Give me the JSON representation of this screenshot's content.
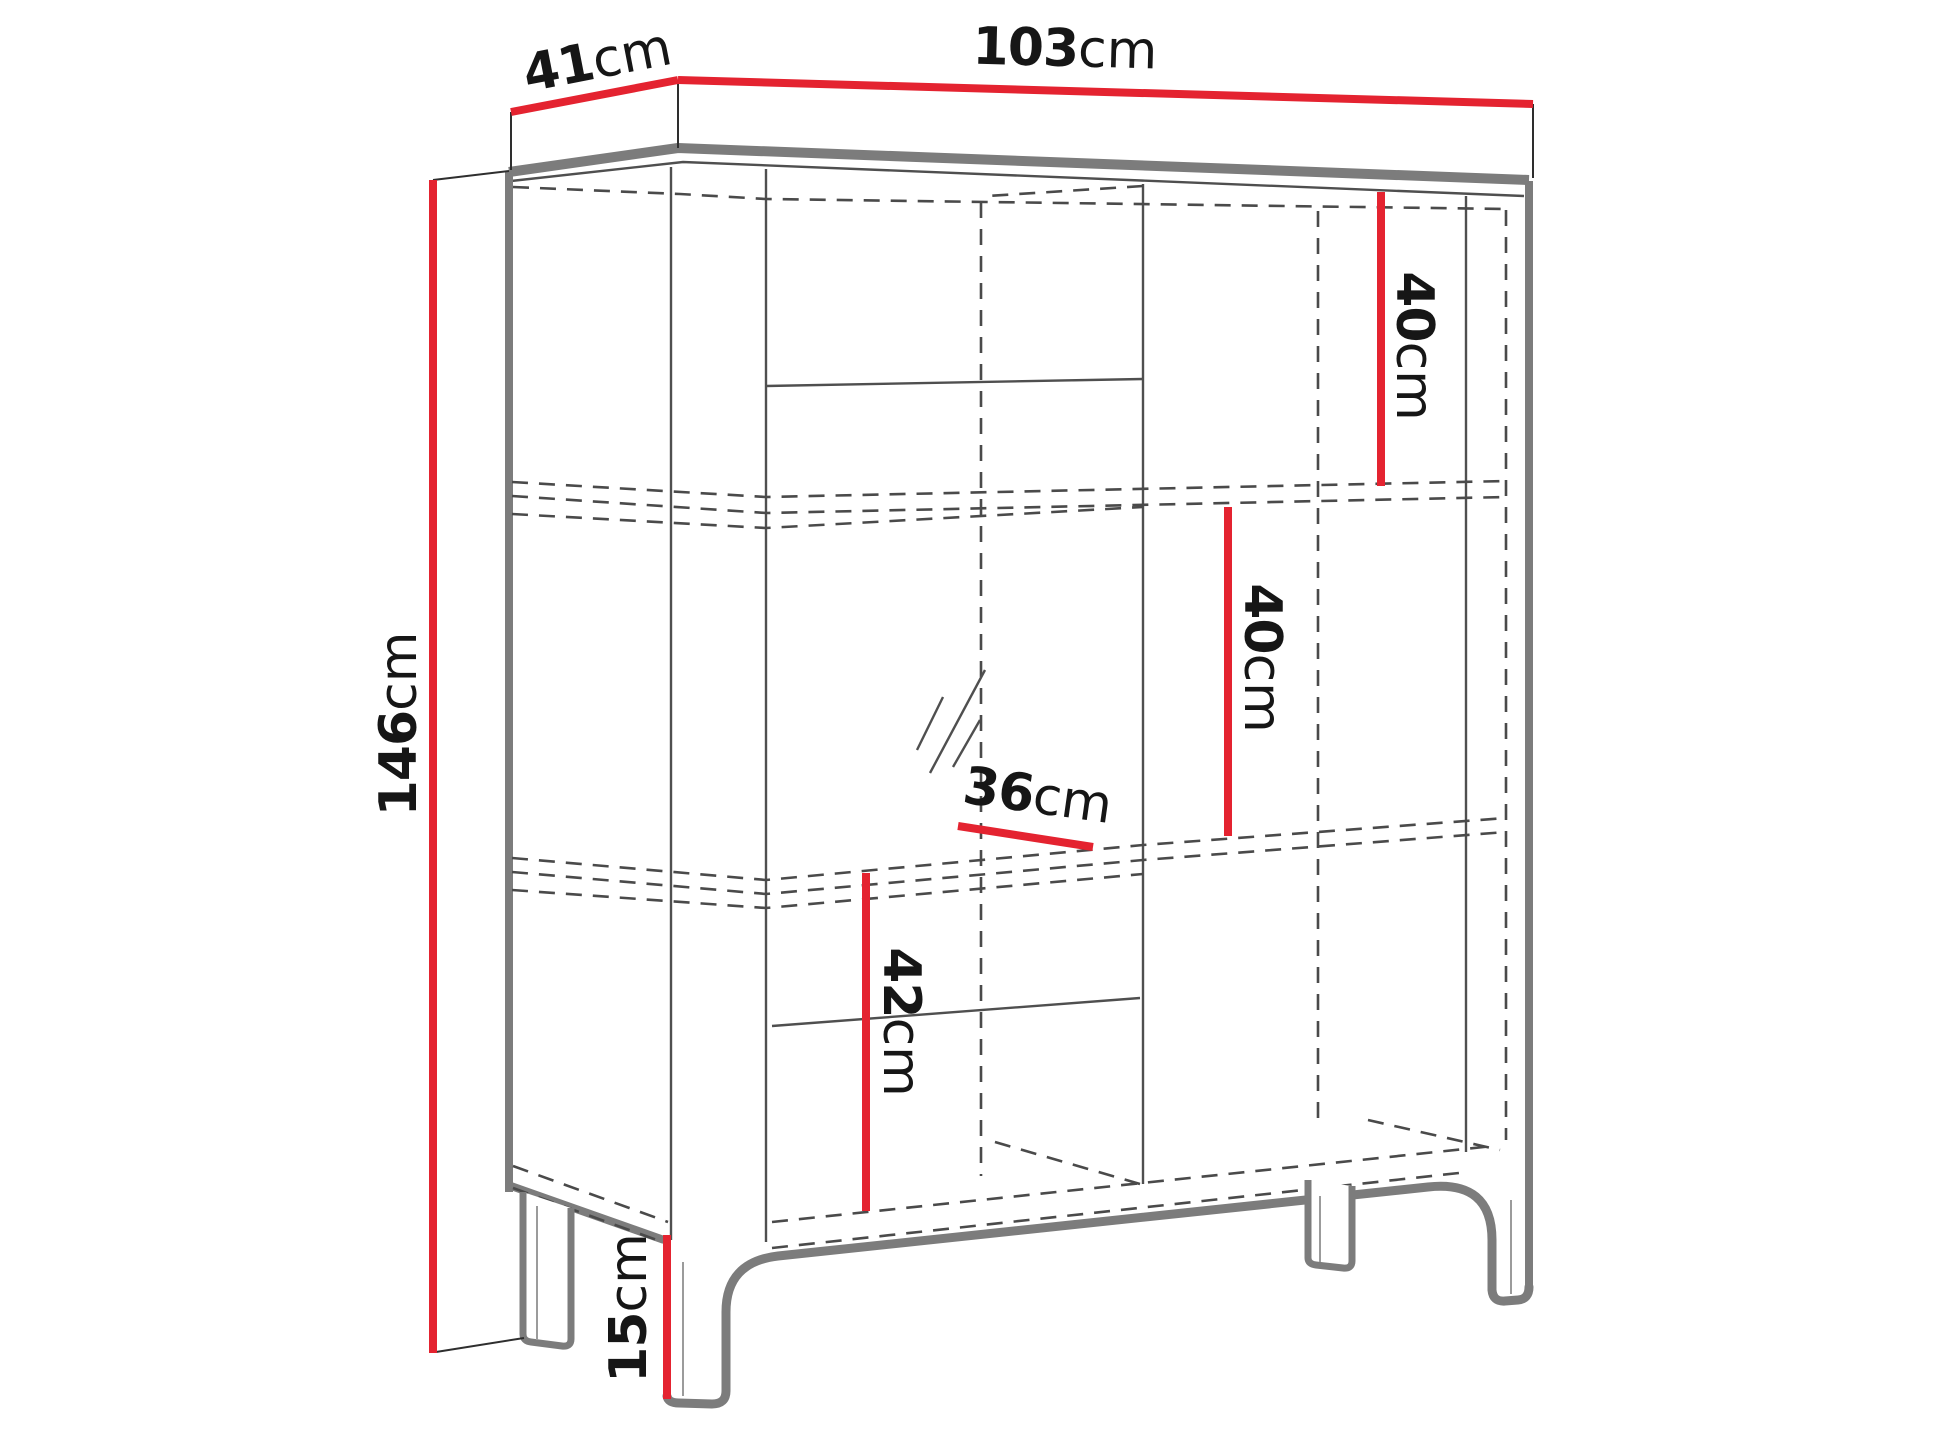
{
  "colors": {
    "dimension_red": "#e42330",
    "outline_gray": "#7c7c7c",
    "hidden_line_gray": "#4a4a4a",
    "text": "#161616",
    "background": "#ffffff"
  },
  "dimensions": {
    "depth": {
      "value": "41",
      "unit": "cm"
    },
    "width": {
      "value": "103",
      "unit": "cm"
    },
    "height": {
      "value": "146",
      "unit": "cm"
    },
    "upper_right_compartment": {
      "value": "40",
      "unit": "cm"
    },
    "middle_right_compartment": {
      "value": "40",
      "unit": "cm"
    },
    "lower_left_compartment": {
      "value": "42",
      "unit": "cm"
    },
    "inner_shelf_depth": {
      "value": "36",
      "unit": "cm"
    },
    "leg_height": {
      "value": "15",
      "unit": "cm"
    }
  }
}
